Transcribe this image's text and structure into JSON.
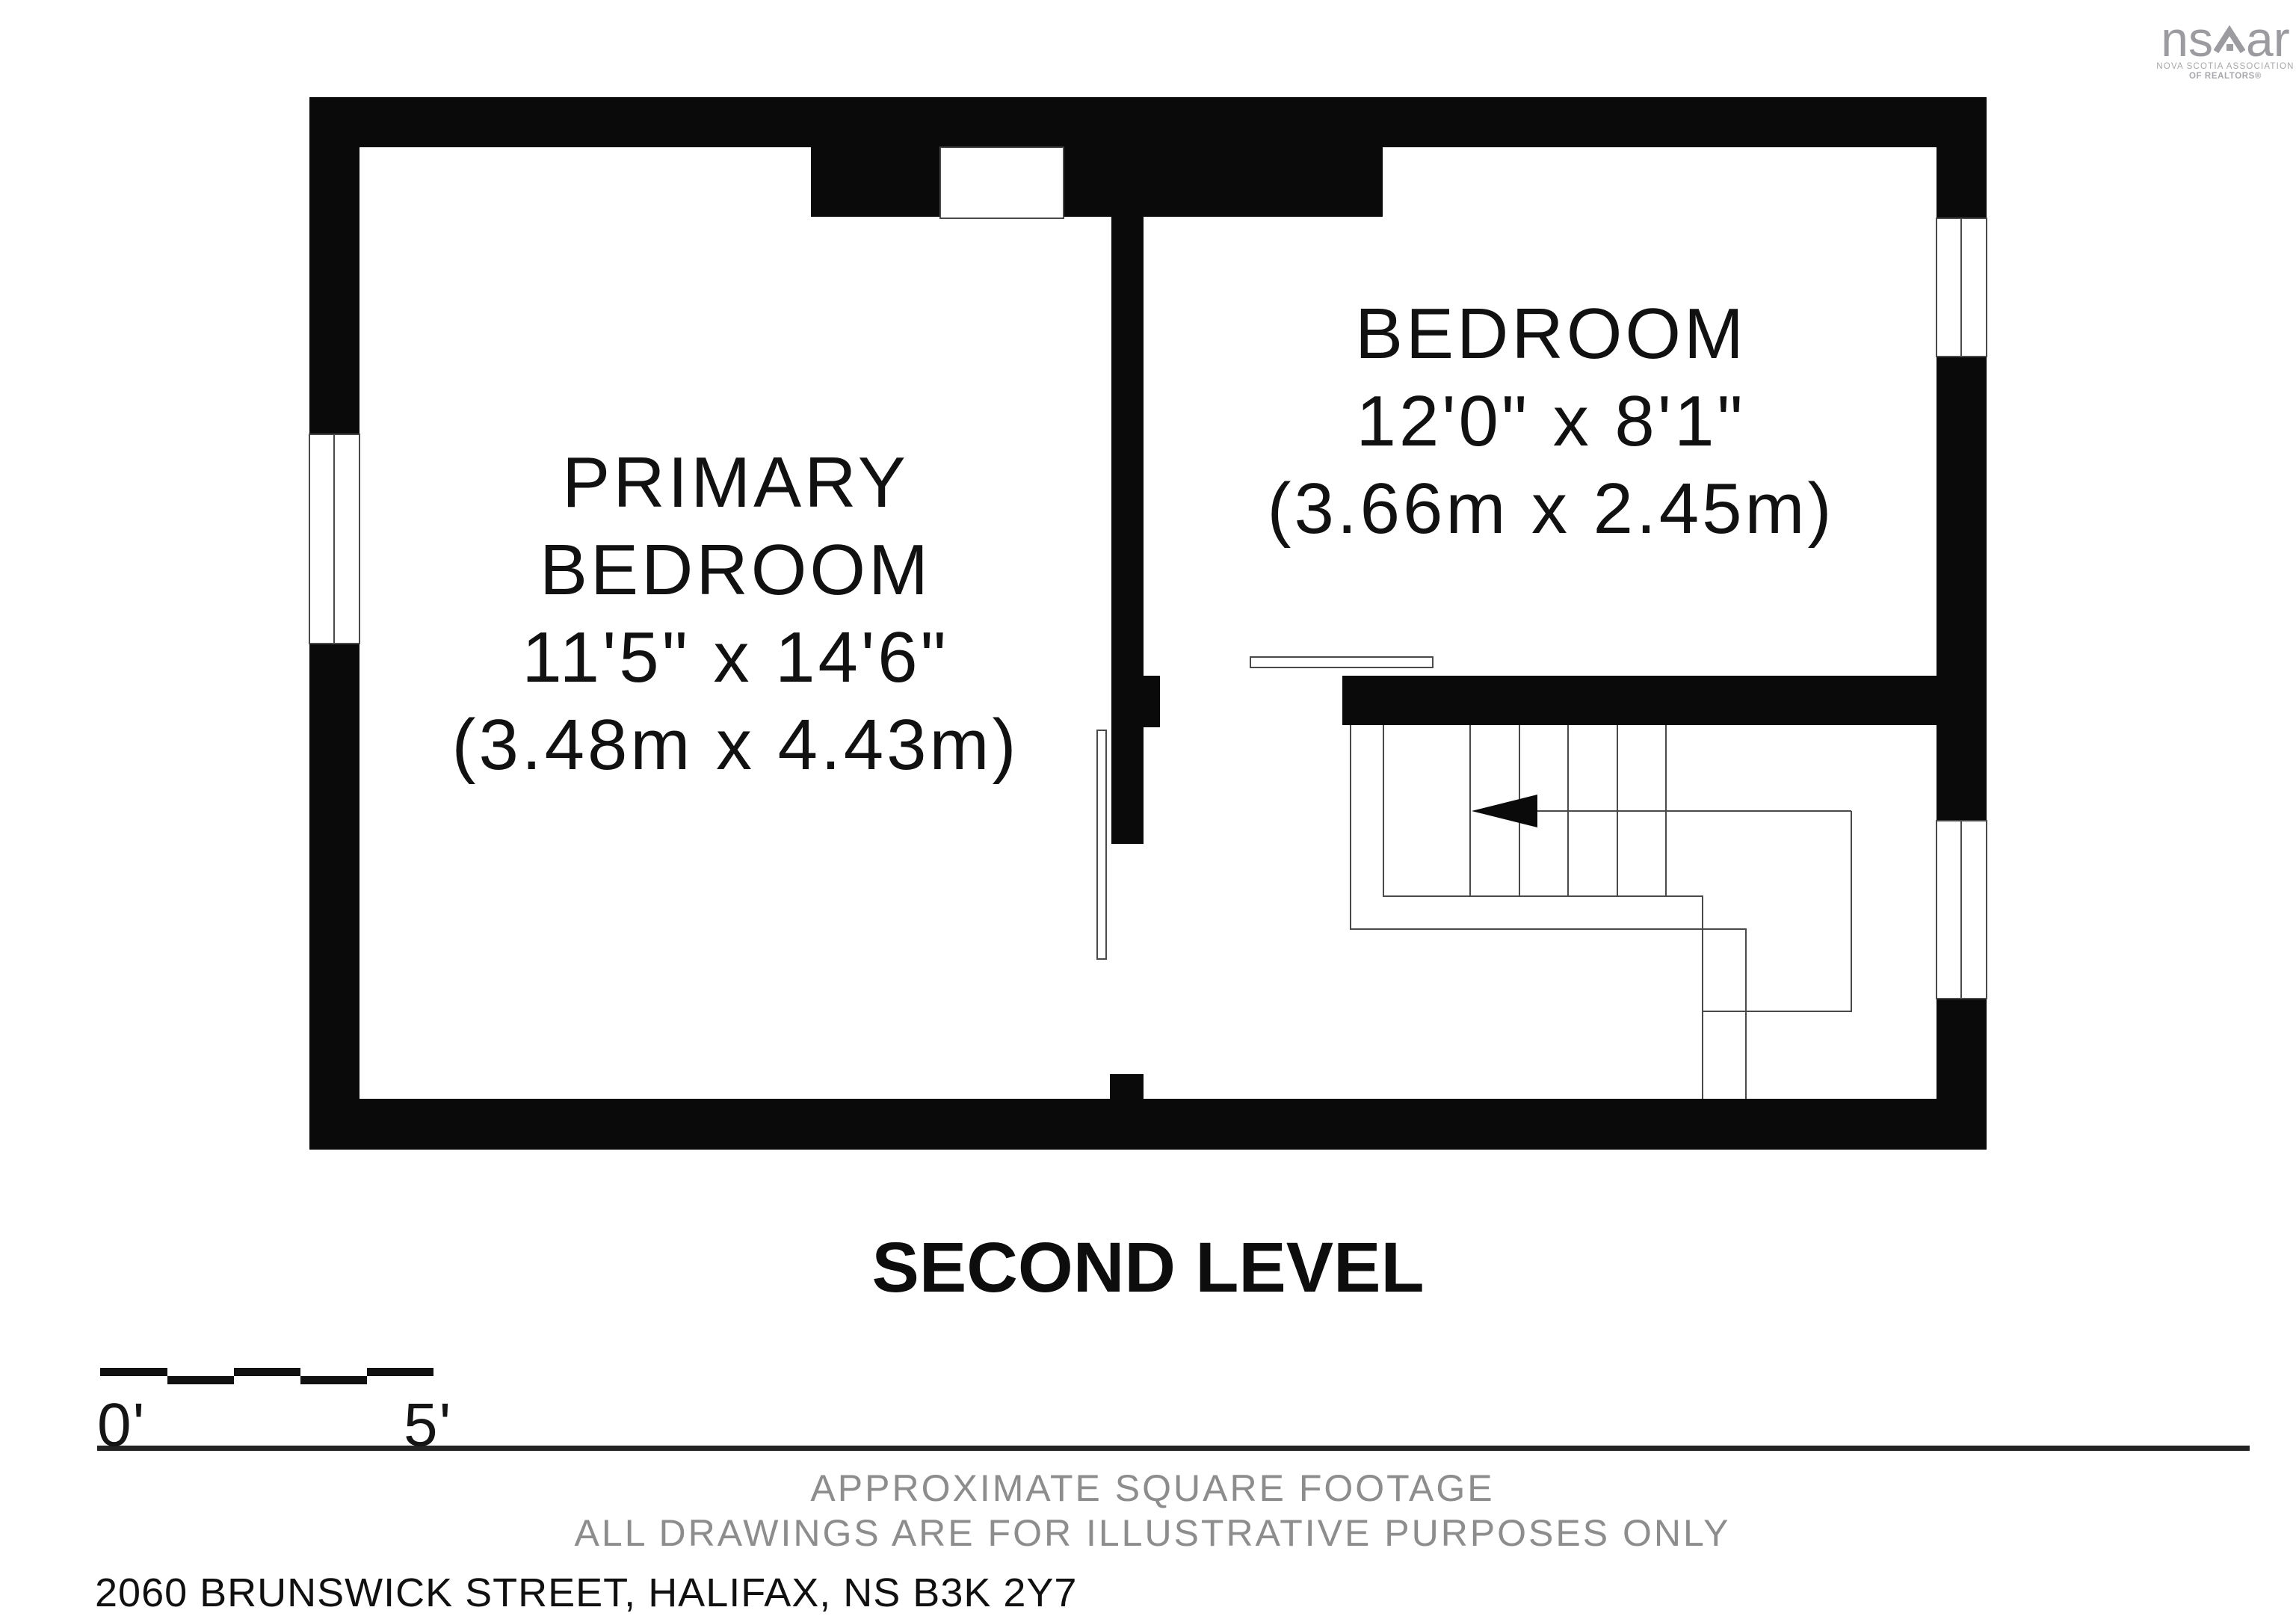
{
  "logo": {
    "wordmark_left": "ns",
    "wordmark_right": "ar",
    "subtext_line1": "NOVA SCOTIA ASSOCIATION",
    "subtext_line2": "OF REALTORS®"
  },
  "rooms": {
    "primary": {
      "name_line1": "PRIMARY",
      "name_line2": "BEDROOM",
      "dims_imperial": "11'5\" x 14'6\"",
      "dims_metric": "(3.48m x 4.43m)"
    },
    "bedroom2": {
      "name": "BEDROOM",
      "dims_imperial": "12'0\" x 8'1\"",
      "dims_metric": "(3.66m x 2.45m)"
    }
  },
  "level_title": "SECOND LEVEL",
  "scale_bar": {
    "label_start": "0'",
    "label_end": "5'"
  },
  "footer": {
    "line1": "APPROXIMATE SQUARE FOOTAGE",
    "line2": "ALL DRAWINGS ARE FOR ILLUSTRATIVE PURPOSES ONLY",
    "address": "2060 BRUNSWICK STREET, HALIFAX, NS B3K 2Y7"
  },
  "colors": {
    "wall": "#0a0a0a",
    "thin_line": "#4a4a4a",
    "gray_text": "#8d8d8d",
    "logo_gray": "#9b9ba0"
  }
}
